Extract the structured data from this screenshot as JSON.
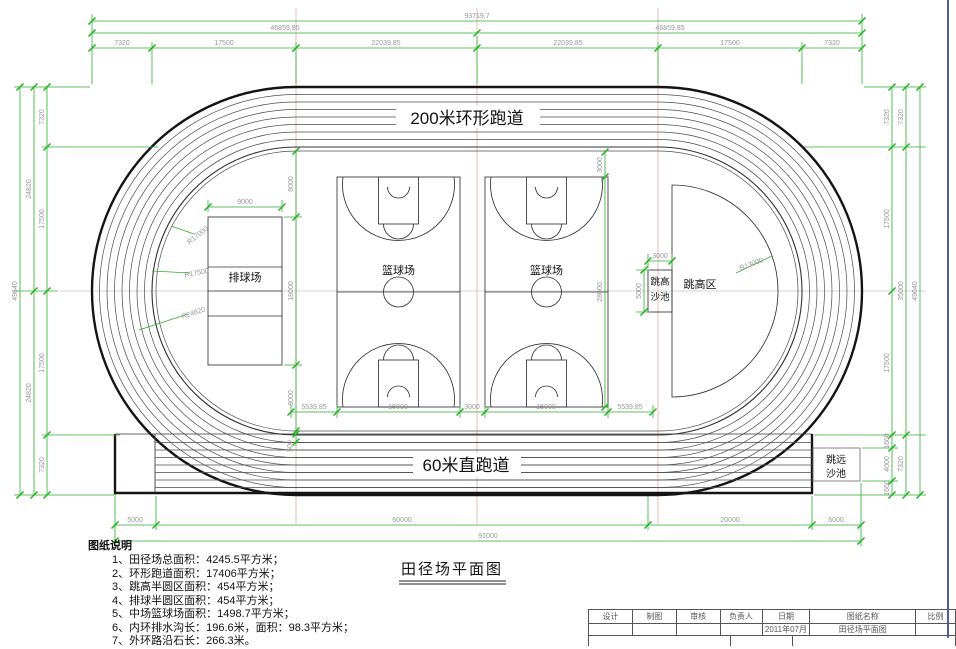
{
  "labels": {
    "ring_track": "200米环形跑道",
    "straight_track": "60米直跑道",
    "volleyball": "排球场",
    "basketball_1": "篮球场",
    "basketball_2": "篮球场",
    "high_jump_area": "跳高区",
    "high_jump_pit_line1": "跳高",
    "high_jump_pit_line2": "沙池",
    "long_jump_pit_line1": "跳远",
    "long_jump_pit_line2": "沙池",
    "plan_title": "田径场平面图"
  },
  "radii": {
    "r17000": "R17000",
    "r17500": "R17500",
    "r24820": "R24820",
    "r13000": "R13000"
  },
  "dims": {
    "top": {
      "total": "93719,7",
      "halves": [
        "46859,85",
        "46859,85"
      ],
      "segs": [
        "7320",
        "17500",
        "22039,85",
        "22039,85",
        "17500",
        "7320"
      ]
    },
    "left": {
      "total": "49640",
      "halves": [
        "24820",
        "24820"
      ],
      "segs": [
        "7320",
        "17500",
        "17500",
        "7320"
      ]
    },
    "right": {
      "col1": [
        "7320",
        "17500",
        "17500",
        "1660",
        "4000",
        "1660"
      ],
      "col2": [
        "7320",
        "35000",
        "7320"
      ],
      "total": "49640"
    },
    "bottom": {
      "segs": [
        "5000",
        "60000",
        "20000",
        "6000"
      ],
      "total": "91000"
    },
    "infield": {
      "volleyball_width": "9000",
      "volleyball_chain": [
        "8000",
        "18000",
        "8000"
      ],
      "court_chain": [
        "3000",
        "28000"
      ],
      "bottom_chain": [
        "5539,85",
        "15000",
        "3000",
        "15000",
        "5539,85"
      ],
      "high_jump_pit_width": "3000",
      "high_jump_pit_height": "5000",
      "lane_width": "500"
    }
  },
  "notes": {
    "heading": "图纸说明",
    "items": [
      "1、田径场总面积：4245.5平方米；",
      "2、环形跑道面积：17406平方米；",
      "3、跳高半圆区面积：454平方米；",
      "4、排球半圆区面积：454平方米；",
      "5、中场篮球场面积：1498.7平方米；",
      "6、内环排水沟长：196.6米，面积：98.3平方米；",
      "7、外环路沿石长：266.3米。"
    ]
  },
  "title_block": {
    "headers": [
      "设计",
      "制图",
      "审核",
      "负责人",
      "日期",
      "图纸名称",
      "比例"
    ],
    "date": "2011年07月",
    "drawing_name": "田径场平面图"
  }
}
